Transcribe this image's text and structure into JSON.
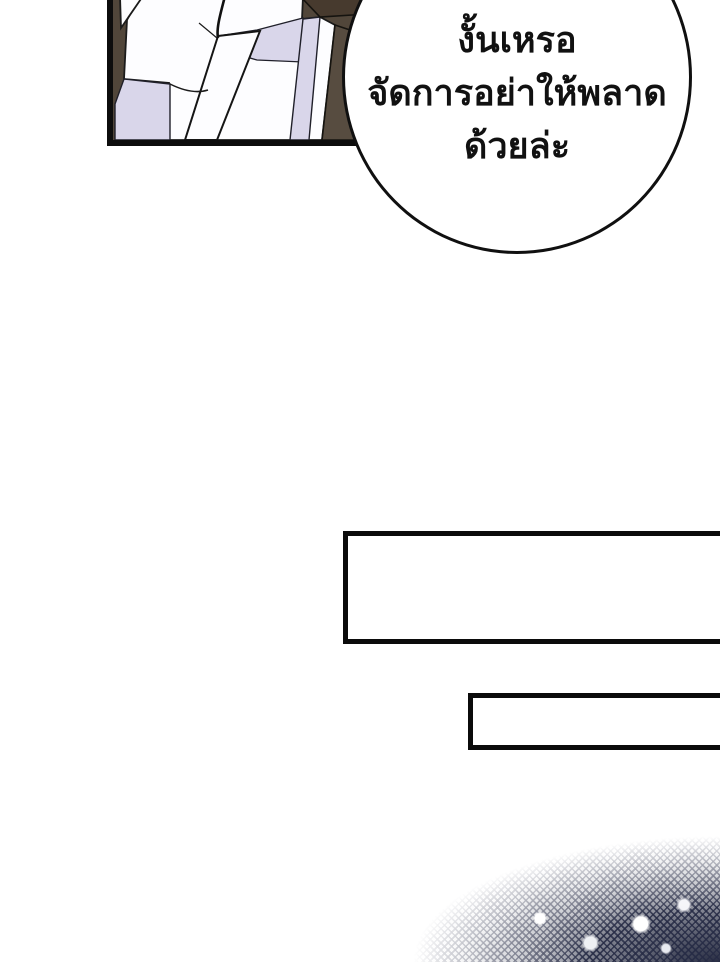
{
  "page": {
    "background": "#ffffff",
    "type": "webtoon-comic-page"
  },
  "panel": {
    "description": "close-up of white clothing with straps on dark background",
    "colors": {
      "background_brown": "#51463a",
      "corner_brown_dark": "#473a2e",
      "right_column_brown": "#574c40",
      "shadow_lavender": "#d9d6ea",
      "cloth_white": "#fdfdff",
      "outline_black": "#1b1b1b",
      "border_black": "#0d0d0d"
    }
  },
  "speech_bubble": {
    "lines": [
      "งั้นเหรอ",
      "จัดการอย่าให้พลาด",
      "ด้วยล่ะ"
    ],
    "fill": "#ffffff",
    "stroke": "#101010",
    "text_color": "#111111"
  },
  "text_boxes": [
    {
      "text": "",
      "border": "#0b0b0b",
      "fill": "#ffffff"
    },
    {
      "text": "",
      "border": "#0b0b0b",
      "fill": "#ffffff"
    }
  ],
  "texture": {
    "description": "halftone crosshatch fading into bottom-right corner",
    "color_navy": "#262b45"
  }
}
